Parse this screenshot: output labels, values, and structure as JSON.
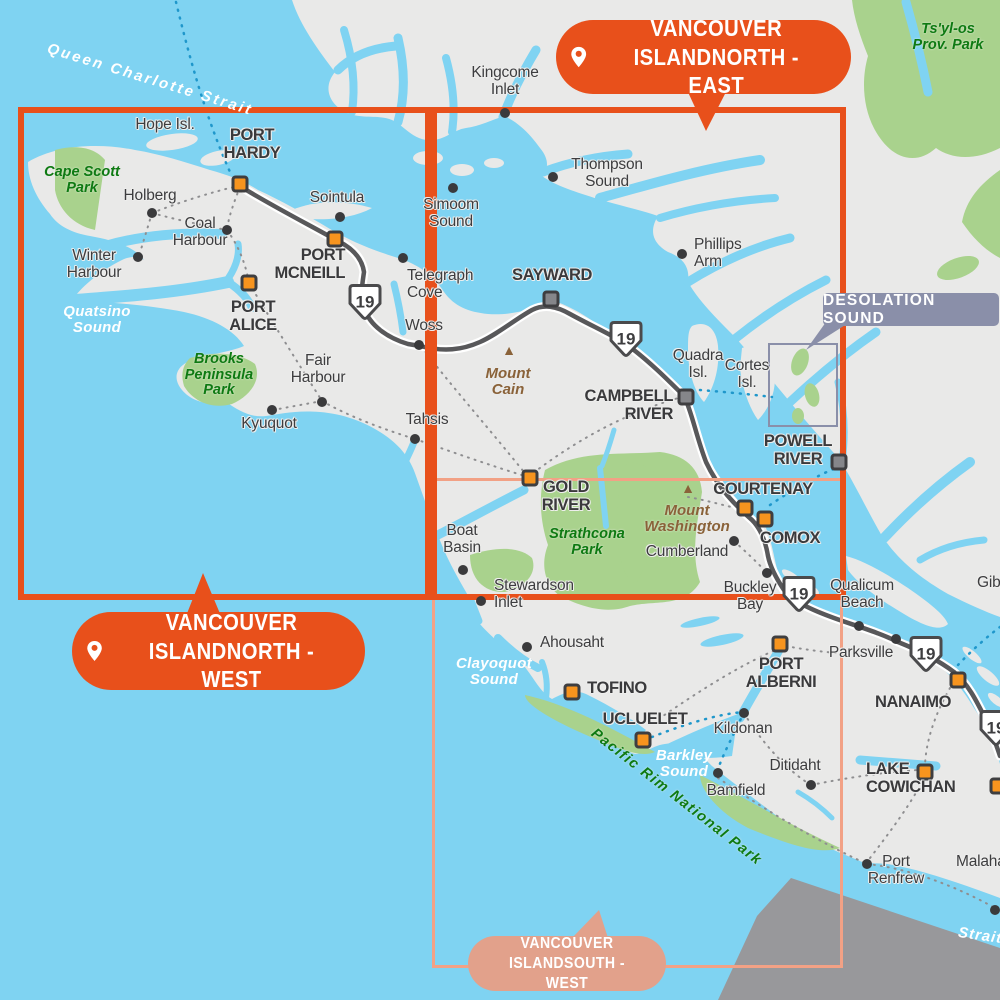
{
  "colors": {
    "ocean": "#7FD3F2",
    "land": "#E9E9E8",
    "park_green": "#A9D28D",
    "park_text": "#0E7A12",
    "accent_orange": "#E8501B",
    "thin_rect": "#F2A185",
    "muted_callout": "#E2A18B",
    "desolation": "#8A8FA9",
    "road": "#58585A",
    "dark_text": "#3A3A3C",
    "brown": "#8A6239",
    "marker_orange": "#F7941E",
    "marker_gray": "#85868A",
    "ferry_blue": "#1F97CB",
    "us_gray": "#98989B"
  },
  "map": {
    "coverage_rects": [
      {
        "id": "south-west",
        "x": 432,
        "y": 478,
        "w": 411,
        "h": 490,
        "stroke": "#F2A185",
        "line_width": 3
      },
      {
        "id": "north-west",
        "x": 18,
        "y": 107,
        "w": 413,
        "h": 493,
        "stroke": "#E8501B",
        "line_width": 6
      },
      {
        "id": "north-east",
        "x": 431,
        "y": 107,
        "w": 415,
        "h": 493,
        "stroke": "#E8501B",
        "line_width": 6
      }
    ],
    "callouts": [
      {
        "id": "north-east",
        "lines": [
          "VANCOUVER ISLAND",
          "NORTH - EAST"
        ],
        "x": 556,
        "y": 20,
        "w": 295,
        "h": 74,
        "bg": "#E8501B",
        "has_pin": true,
        "font": 23,
        "pointer": "687,90 727,90 706,131"
      },
      {
        "id": "north-west",
        "lines": [
          "VANCOUVER ISLAND",
          "NORTH - WEST"
        ],
        "x": 72,
        "y": 612,
        "w": 293,
        "h": 78,
        "bg": "#E8501B",
        "has_pin": true,
        "font": 23,
        "pointer": "186,616 221,616 203,573"
      },
      {
        "id": "south-west",
        "lines": [
          "VANCOUVER ISLAND",
          "SOUTH - WEST"
        ],
        "x": 468,
        "y": 936,
        "w": 198,
        "h": 55,
        "bg": "#E2A18B",
        "has_pin": false,
        "font": 16,
        "pointer": "572,938 608,938 599,910"
      }
    ],
    "region_callout": {
      "id": "desolation-sound",
      "text": "DESOLATION SOUND",
      "x": 823,
      "y": 293,
      "w": 176,
      "h": 33,
      "bg": "#8A8FA9",
      "tail": "826,322 850,322 806,350",
      "box": {
        "x": 768,
        "y": 343,
        "w": 70,
        "h": 84
      }
    },
    "cities": [
      {
        "id": "port-hardy",
        "marker": "orange",
        "mx": 240,
        "my": 184,
        "x": 252,
        "y": 127,
        "align": "center",
        "lines": [
          "PORT",
          "HARDY"
        ]
      },
      {
        "id": "port-mcneill",
        "marker": "orange",
        "mx": 335,
        "my": 239,
        "x": 345,
        "y": 247,
        "align": "right",
        "lines": [
          "PORT",
          "MCNEILL"
        ]
      },
      {
        "id": "port-alice",
        "marker": "orange",
        "mx": 249,
        "my": 283,
        "x": 253,
        "y": 299,
        "align": "center",
        "lines": [
          "PORT",
          "ALICE"
        ]
      },
      {
        "id": "gold-river",
        "marker": "orange",
        "mx": 530,
        "my": 478,
        "x": 566,
        "y": 479,
        "align": "center",
        "lines": [
          "GOLD",
          "RIVER"
        ]
      },
      {
        "id": "courtenay",
        "marker": "orange",
        "mx": 745,
        "my": 508,
        "x": 763,
        "y": 481,
        "align": "center",
        "lines": [
          "COURTENAY"
        ]
      },
      {
        "id": "comox",
        "marker": "orange",
        "mx": 765,
        "my": 519,
        "x": 790,
        "y": 530,
        "align": "center",
        "lines": [
          "COMOX"
        ]
      },
      {
        "id": "tofino",
        "marker": "orange",
        "mx": 572,
        "my": 692,
        "x": 617,
        "y": 680,
        "align": "center",
        "lines": [
          "TOFINO"
        ]
      },
      {
        "id": "ucluelet",
        "marker": "orange",
        "mx": 643,
        "my": 740,
        "x": 645,
        "y": 711,
        "align": "center",
        "lines": [
          "UCLUELET"
        ]
      },
      {
        "id": "port-alberni",
        "marker": "orange",
        "mx": 780,
        "my": 644,
        "x": 781,
        "y": 656,
        "align": "center",
        "lines": [
          "PORT",
          "ALBERNI"
        ]
      },
      {
        "id": "nanaimo",
        "marker": "orange",
        "mx": 958,
        "my": 680,
        "x": 913,
        "y": 694,
        "align": "center",
        "lines": [
          "NANAIMO"
        ]
      },
      {
        "id": "lake-cowichan",
        "marker": "orange",
        "mx": 925,
        "my": 772,
        "x": 866,
        "y": 761,
        "align": "left",
        "lines": [
          "LAKE",
          "COWICHAN"
        ]
      },
      {
        "id": "edge-town",
        "marker": "orange",
        "mx": 998,
        "my": 786,
        "x": 0,
        "y": 0,
        "align": "left",
        "lines": []
      },
      {
        "id": "sayward",
        "marker": "gray",
        "mx": 551,
        "my": 299,
        "x": 552,
        "y": 267,
        "align": "center",
        "lines": [
          "SAYWARD"
        ]
      },
      {
        "id": "campbell-river",
        "marker": "gray",
        "mx": 686,
        "my": 397,
        "x": 673,
        "y": 388,
        "align": "right",
        "lines": [
          "CAMPBELL",
          "RIVER"
        ]
      },
      {
        "id": "powell-river",
        "marker": "gray",
        "mx": 839,
        "my": 462,
        "x": 798,
        "y": 433,
        "align": "center",
        "lines": [
          "POWELL",
          "RIVER"
        ]
      }
    ],
    "towns": [
      {
        "id": "holberg",
        "dot": true,
        "dx": 152,
        "dy": 213,
        "x": 150,
        "y": 188,
        "align": "center",
        "lines": [
          "Holberg"
        ]
      },
      {
        "id": "coal-harbour",
        "dot": true,
        "dx": 227,
        "dy": 230,
        "x": 200,
        "y": 216,
        "align": "center",
        "lines": [
          "Coal",
          "Harbour"
        ]
      },
      {
        "id": "winter-harbour",
        "dot": true,
        "dx": 138,
        "dy": 257,
        "x": 94,
        "y": 248,
        "align": "center",
        "lines": [
          "Winter",
          "Harbour"
        ]
      },
      {
        "id": "sointula",
        "dot": true,
        "dx": 340,
        "dy": 217,
        "x": 337,
        "y": 190,
        "align": "center",
        "lines": [
          "Sointula"
        ]
      },
      {
        "id": "telegraph-cove",
        "dot": true,
        "dx": 403,
        "dy": 258,
        "x": 407,
        "y": 268,
        "align": "left",
        "lines": [
          "Telegraph",
          "Cove"
        ]
      },
      {
        "id": "woss",
        "dot": true,
        "dx": 419,
        "dy": 345,
        "x": 424,
        "y": 318,
        "align": "center",
        "lines": [
          "Woss"
        ]
      },
      {
        "id": "kingcome-inlet",
        "dot": true,
        "dx": 505,
        "dy": 113,
        "x": 505,
        "y": 65,
        "align": "center",
        "lines": [
          "Kingcome",
          "Inlet"
        ]
      },
      {
        "id": "simoom-sound",
        "dot": true,
        "dx": 453,
        "dy": 188,
        "x": 451,
        "y": 197,
        "align": "center",
        "lines": [
          "Simoom",
          "Sound"
        ]
      },
      {
        "id": "thompson-sound",
        "dot": true,
        "dx": 553,
        "dy": 177,
        "x": 607,
        "y": 157,
        "align": "center",
        "lines": [
          "Thompson",
          "Sound"
        ]
      },
      {
        "id": "phillips-arm",
        "dot": true,
        "dx": 682,
        "dy": 254,
        "x": 694,
        "y": 237,
        "align": "left",
        "lines": [
          "Phillips",
          "Arm"
        ]
      },
      {
        "id": "fair-harbour",
        "dot": true,
        "dx": 322,
        "dy": 402,
        "x": 318,
        "y": 353,
        "align": "center",
        "lines": [
          "Fair",
          "Harbour"
        ]
      },
      {
        "id": "kyuquot",
        "dot": true,
        "dx": 272,
        "dy": 410,
        "x": 269,
        "y": 416,
        "align": "center",
        "lines": [
          "Kyuquot"
        ]
      },
      {
        "id": "tahsis",
        "dot": true,
        "dx": 415,
        "dy": 439,
        "x": 427,
        "y": 412,
        "align": "center",
        "lines": [
          "Tahsis"
        ]
      },
      {
        "id": "boat-basin",
        "dot": true,
        "dx": 463,
        "dy": 570,
        "x": 462,
        "y": 523,
        "align": "center",
        "lines": [
          "Boat",
          "Basin"
        ]
      },
      {
        "id": "stewardson-inlet",
        "dot": true,
        "dx": 481,
        "dy": 601,
        "x": 494,
        "y": 578,
        "align": "left",
        "lines": [
          "Stewardson",
          "Inlet"
        ]
      },
      {
        "id": "ahousaht",
        "dot": true,
        "dx": 527,
        "dy": 647,
        "x": 540,
        "y": 635,
        "align": "left",
        "lines": [
          "Ahousaht"
        ]
      },
      {
        "id": "cumberland",
        "dot": true,
        "dx": 734,
        "dy": 541,
        "x": 687,
        "y": 544,
        "align": "center",
        "lines": [
          "Cumberland"
        ]
      },
      {
        "id": "buckley-bay",
        "dot": true,
        "dx": 767,
        "dy": 573,
        "x": 750,
        "y": 580,
        "align": "center",
        "lines": [
          "Buckley",
          "Bay"
        ]
      },
      {
        "id": "qualicum-beach",
        "dot": true,
        "dx": 859,
        "dy": 626,
        "x": 862,
        "y": 578,
        "align": "center",
        "lines": [
          "Qualicum",
          "Beach"
        ]
      },
      {
        "id": "parksville",
        "dot": true,
        "dx": 896,
        "dy": 639,
        "x": 861,
        "y": 645,
        "align": "center",
        "lines": [
          "Parksville"
        ]
      },
      {
        "id": "kildonan",
        "dot": true,
        "dx": 744,
        "dy": 713,
        "x": 743,
        "y": 721,
        "align": "center",
        "lines": [
          "Kildonan"
        ]
      },
      {
        "id": "ditidaht",
        "dot": true,
        "dx": 811,
        "dy": 785,
        "x": 795,
        "y": 758,
        "align": "center",
        "lines": [
          "Ditidaht"
        ]
      },
      {
        "id": "bamfield",
        "dot": true,
        "dx": 718,
        "dy": 773,
        "x": 736,
        "y": 783,
        "align": "center",
        "lines": [
          "Bamfield"
        ]
      },
      {
        "id": "port-renfrew",
        "dot": true,
        "dx": 867,
        "dy": 864,
        "x": 896,
        "y": 854,
        "align": "center",
        "lines": [
          "Port",
          "Renfrew"
        ]
      },
      {
        "id": "malahat",
        "dot": true,
        "dx": 995,
        "dy": 910,
        "x": 956,
        "y": 854,
        "align": "left",
        "lines": [
          "Malahat"
        ]
      },
      {
        "id": "gibsons",
        "dot": false,
        "dx": 0,
        "dy": 0,
        "x": 977,
        "y": 575,
        "align": "left",
        "lines": [
          "Gibsons"
        ]
      }
    ],
    "islands": [
      {
        "id": "hope-island",
        "x": 165,
        "y": 117,
        "align": "center",
        "lines": [
          "Hope Isl."
        ]
      },
      {
        "id": "quadra-island",
        "x": 698,
        "y": 348,
        "align": "center",
        "lines": [
          "Quadra",
          "Isl."
        ]
      },
      {
        "id": "cortes-island",
        "x": 747,
        "y": 358,
        "align": "center",
        "lines": [
          "Cortes",
          "Isl."
        ]
      }
    ],
    "water_labels": [
      {
        "id": "queen-charlotte-strait",
        "x": 150,
        "y": 72,
        "align": "center",
        "rot": 17,
        "ls": 2.5,
        "lines": [
          "Queen Charlotte Strait"
        ]
      },
      {
        "id": "quatsino-sound",
        "x": 97,
        "y": 304,
        "align": "center",
        "rot": 0,
        "ls": 0,
        "lines": [
          "Quatsino",
          "Sound"
        ]
      },
      {
        "id": "clayoquot-sound",
        "x": 494,
        "y": 656,
        "align": "center",
        "rot": 0,
        "ls": 0,
        "lines": [
          "Clayoquot",
          "Sound"
        ]
      },
      {
        "id": "barkley-sound",
        "x": 684,
        "y": 748,
        "align": "center",
        "rot": 0,
        "ls": 0,
        "lines": [
          "Barkley",
          "Sound"
        ]
      },
      {
        "id": "strait-of-juan-de-fuca",
        "x": 958,
        "y": 928,
        "align": "left",
        "rot": 8,
        "ls": 1,
        "lines": [
          "Strait"
        ]
      }
    ],
    "park_labels": [
      {
        "id": "cape-scott-park",
        "x": 82,
        "y": 165,
        "align": "center",
        "rot": 0,
        "ls": 0,
        "lines": [
          "Cape Scott",
          "Park"
        ]
      },
      {
        "id": "brooks-peninsula-park",
        "x": 219,
        "y": 352,
        "align": "center",
        "rot": 0,
        "ls": 0,
        "lines": [
          "Brooks",
          "Peninsula",
          "Park"
        ]
      },
      {
        "id": "strathcona-park",
        "x": 587,
        "y": 527,
        "align": "center",
        "rot": 0,
        "ls": 0,
        "lines": [
          "Strathcona",
          "Park"
        ]
      },
      {
        "id": "tsyl-os-prov-park",
        "x": 948,
        "y": 22,
        "align": "center",
        "rot": 0,
        "ls": 0,
        "lines": [
          "Ts'yl-os",
          "Prov. Park"
        ]
      },
      {
        "id": "pacific-rim-national-park",
        "x": 676,
        "y": 790,
        "align": "center",
        "rot": 38,
        "ls": 1.5,
        "lines": [
          "Pacific Rim National Park"
        ]
      }
    ],
    "mountains": [
      {
        "id": "mount-cain",
        "tx": 509,
        "ty": 350,
        "x": 508,
        "y": 366,
        "lines": [
          "Mount",
          "Cain"
        ]
      },
      {
        "id": "mount-washington",
        "tx": 688,
        "ty": 488,
        "x": 687,
        "y": 503,
        "lines": [
          "Mount",
          "Washington"
        ]
      }
    ],
    "highway_shields": [
      {
        "number": "19",
        "x": 365,
        "y": 305
      },
      {
        "number": "19",
        "x": 626,
        "y": 342
      },
      {
        "number": "19",
        "x": 799,
        "y": 597
      },
      {
        "number": "19",
        "x": 926,
        "y": 657
      },
      {
        "number": "19",
        "x": 996,
        "y": 731
      }
    ]
  }
}
